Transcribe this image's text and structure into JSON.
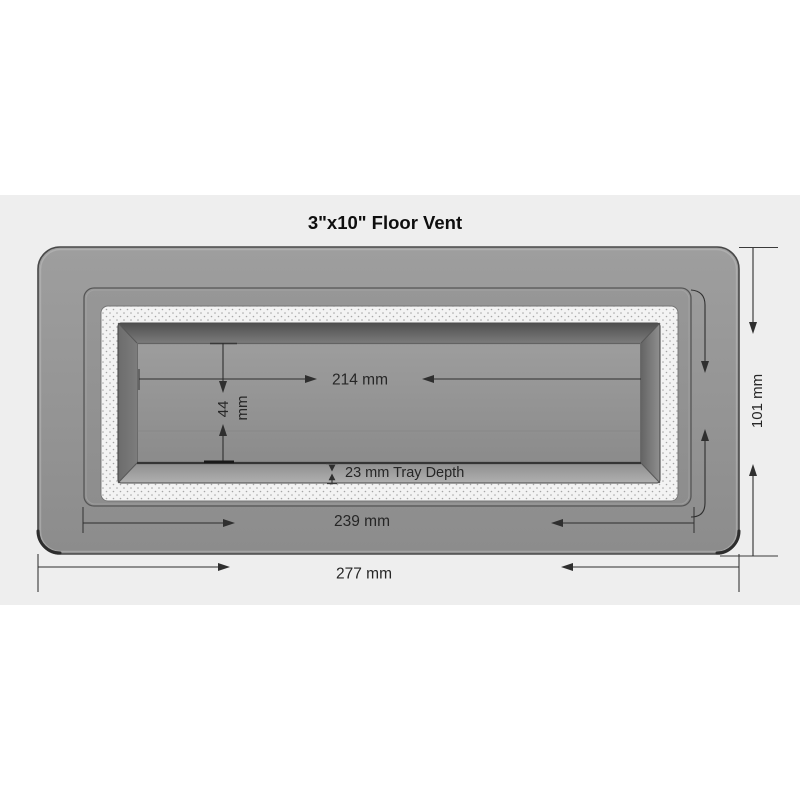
{
  "title": "3\"x10\" Floor Vent",
  "diagram": {
    "product": "floor-vent-top-view",
    "background_color": "#eeeeee",
    "page_background": "#ffffff",
    "flange_color": "#949494",
    "gasket_color": "#f3f3f3",
    "tray_floor_color": "#949494",
    "outline_color": "#484848",
    "dimension_line_color": "#2f2f2f"
  },
  "dimensions": {
    "tray_width": "214 mm",
    "tray_height_value": "44",
    "tray_height_unit": "mm",
    "tray_depth_note": "23 mm Tray Depth",
    "frame_width": "239 mm",
    "overall_width": "277 mm",
    "overall_height": "101 mm"
  }
}
